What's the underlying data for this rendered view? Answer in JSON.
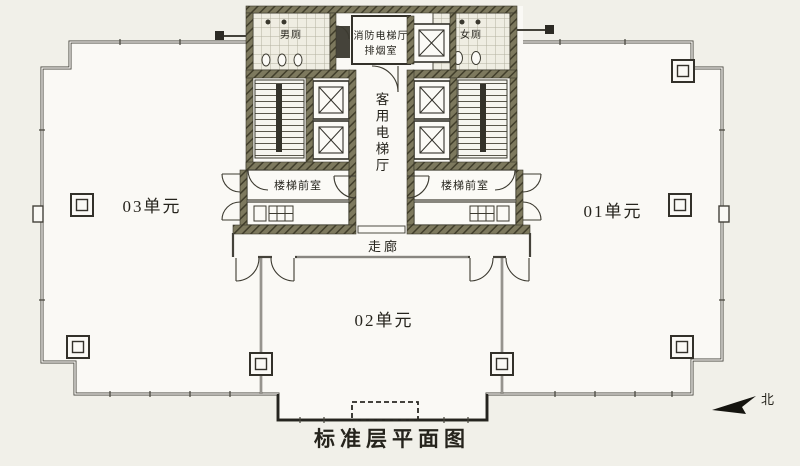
{
  "title": "标准层平面图",
  "north": {
    "label": "北"
  },
  "units": {
    "unit_01": {
      "label": "01单元"
    },
    "unit_02": {
      "label": "02单元"
    },
    "unit_03": {
      "label": "03单元"
    }
  },
  "core": {
    "mens_toilet": {
      "label": "男厕"
    },
    "womens_toilet": {
      "label": "女厕"
    },
    "smoke_room": {
      "line1": "消防电梯厅",
      "line2": "排烟室"
    },
    "elevator_hall": {
      "label": "客用电梯厅"
    },
    "vestibule_left": {
      "label": "楼梯前室"
    },
    "vestibule_right": {
      "label": "楼梯前室"
    },
    "corridor": {
      "label": "走廊"
    }
  },
  "colors": {
    "paper": "#f1f0e9",
    "floor": "#faf9f5",
    "line": "#3c3a30",
    "wall_hatch": "#7d795e",
    "wall_hatch_line": "#413e2b"
  }
}
